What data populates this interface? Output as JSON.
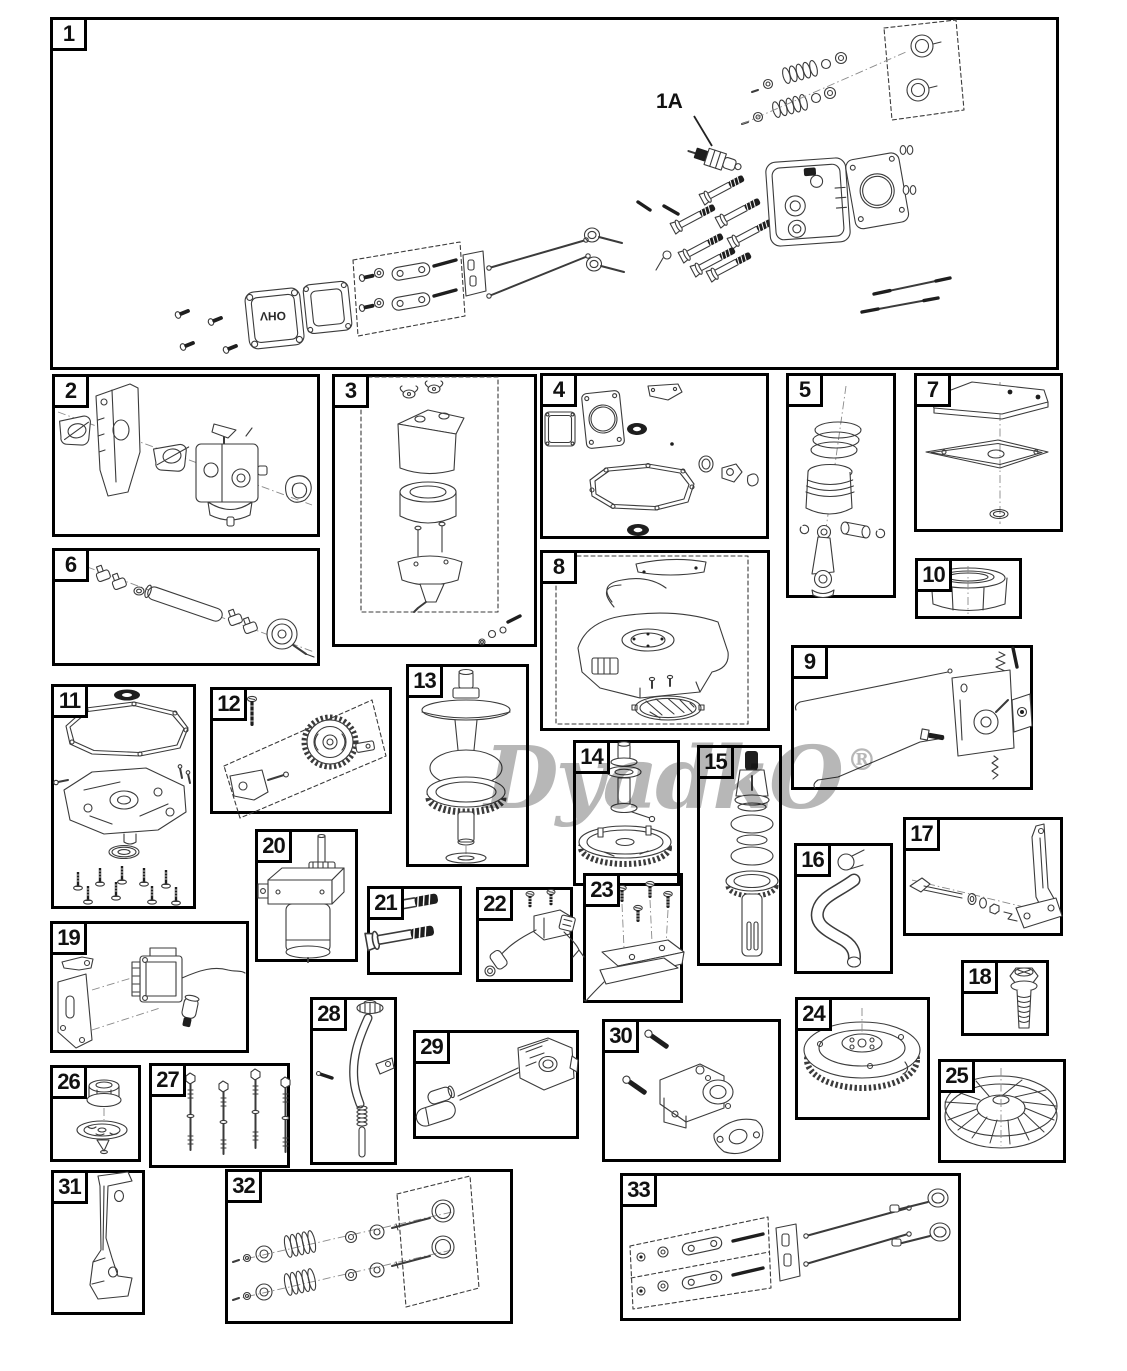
{
  "watermark": {
    "text": "DyadkO",
    "registered_mark": "®"
  },
  "box1": {
    "callout": "1A",
    "valve_cover_text": "OHV"
  },
  "boxes": [
    {
      "num": "1",
      "name": "cylinder-head-assembly"
    },
    {
      "num": "2",
      "name": "carburetor-heat-shield"
    },
    {
      "num": "3",
      "name": "air-cleaner-assembly"
    },
    {
      "num": "4",
      "name": "engine-gasket-set"
    },
    {
      "num": "5",
      "name": "piston-connecting-rod"
    },
    {
      "num": "6",
      "name": "hose-and-clamps"
    },
    {
      "num": "7",
      "name": "breather-cover-gasket"
    },
    {
      "num": "8",
      "name": "blower-housing-screen"
    },
    {
      "num": "9",
      "name": "governor-control-assembly"
    },
    {
      "num": "10",
      "name": "air-filter-element"
    },
    {
      "num": "11",
      "name": "oil-sump-hardware"
    },
    {
      "num": "12",
      "name": "governor-gear-kit"
    },
    {
      "num": "13",
      "name": "crankshaft"
    },
    {
      "num": "14",
      "name": "camshaft"
    },
    {
      "num": "15",
      "name": "pto-shaft"
    },
    {
      "num": "16",
      "name": "breather-tube"
    },
    {
      "num": "17",
      "name": "governor-arm-linkage"
    },
    {
      "num": "18",
      "name": "flange-bolt"
    },
    {
      "num": "19",
      "name": "ignition-coil-bracket"
    },
    {
      "num": "20",
      "name": "electric-starter-motor"
    },
    {
      "num": "21",
      "name": "mounting-bolts"
    },
    {
      "num": "22",
      "name": "stop-switch-wiring"
    },
    {
      "num": "23",
      "name": "control-plate-screws"
    },
    {
      "num": "24",
      "name": "flywheel"
    },
    {
      "num": "25",
      "name": "cooling-fan"
    },
    {
      "num": "26",
      "name": "flywheel-nut-starter-cup"
    },
    {
      "num": "27",
      "name": "cylinder-studs"
    },
    {
      "num": "28",
      "name": "oil-dipstick-tube"
    },
    {
      "num": "29",
      "name": "oil-drain-extension"
    },
    {
      "num": "30",
      "name": "exhaust-manifold-gasket"
    },
    {
      "num": "31",
      "name": "mounting-bracket"
    },
    {
      "num": "32",
      "name": "valve-overhaul-kit"
    },
    {
      "num": "33",
      "name": "rocker-arm-push-rod-kit"
    }
  ]
}
